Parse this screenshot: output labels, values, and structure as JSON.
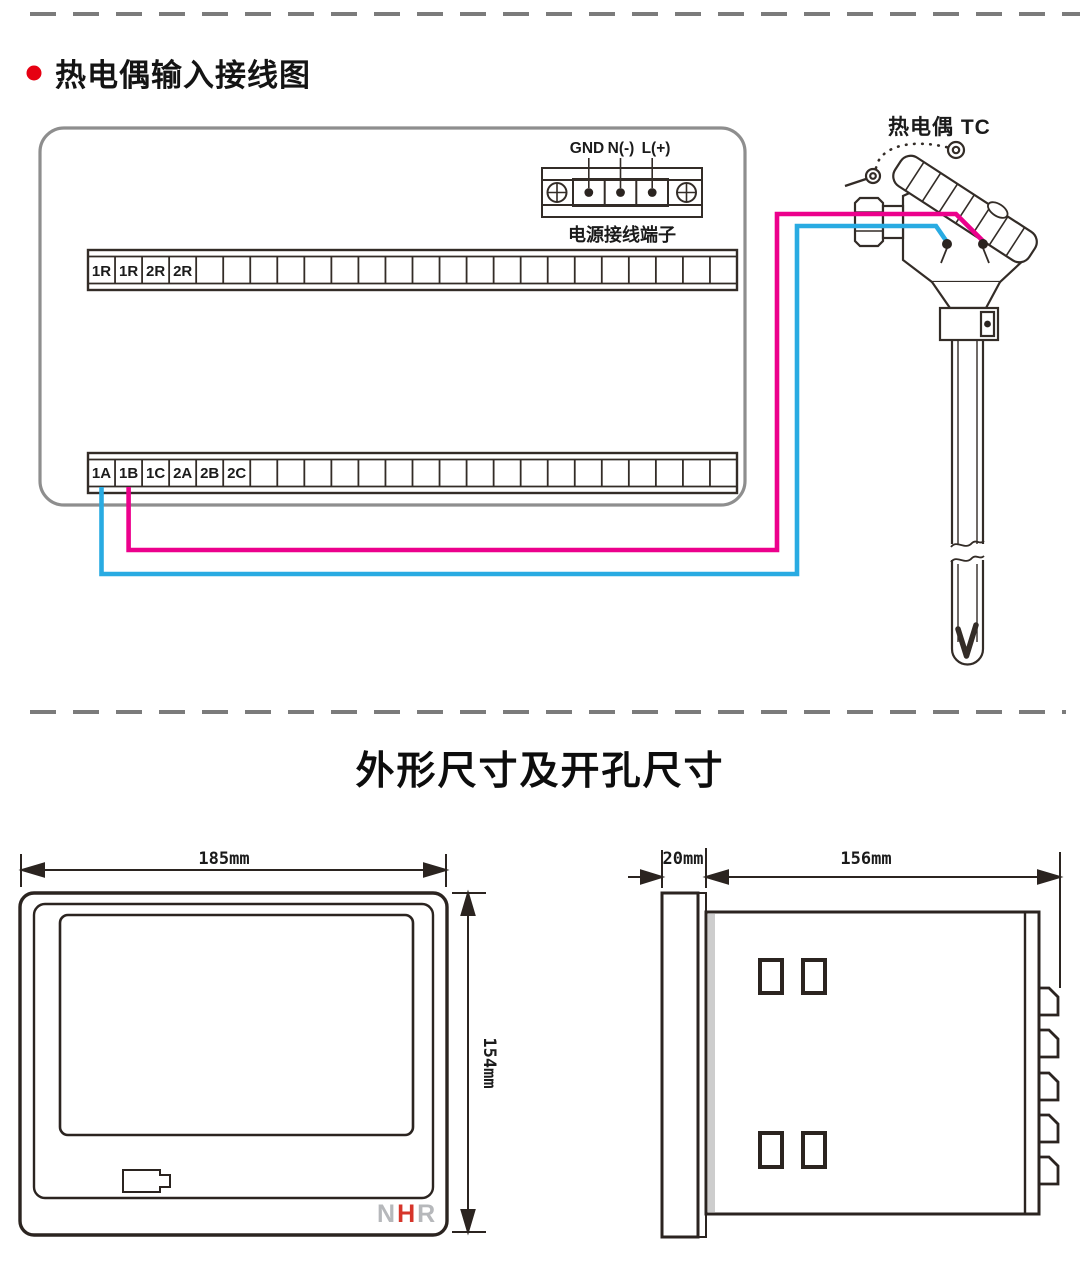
{
  "wiring_section": {
    "bullet_color": "#e60012",
    "title": "热电偶输入接线图",
    "power_terminal": {
      "label_gnd": "GND",
      "label_n": "N(-)",
      "label_l": "L(+)",
      "caption": "电源接线端子"
    },
    "top_strip": {
      "labels": [
        "1R",
        "1R",
        "2R",
        "2R"
      ]
    },
    "bottom_strip": {
      "labels": [
        "1A",
        "1B",
        "1C",
        "2A",
        "2B",
        "2C"
      ]
    },
    "sensor_label": "热电偶 TC",
    "colors": {
      "wire_positive": "#ec008c",
      "wire_negative": "#29abe2",
      "panel_border": "#8e8e8e",
      "ink": "#332c27"
    }
  },
  "dimensions_section": {
    "title": "外形尺寸及开孔尺寸",
    "front_view": {
      "width_label": "185mm",
      "height_label": "154mm",
      "logo": {
        "n": "N",
        "h": "H",
        "r": "R",
        "grey": "#b6b8bb",
        "red": "#d6352a"
      }
    },
    "side_view": {
      "depth_label": "20mm",
      "width_label": "156mm"
    }
  }
}
